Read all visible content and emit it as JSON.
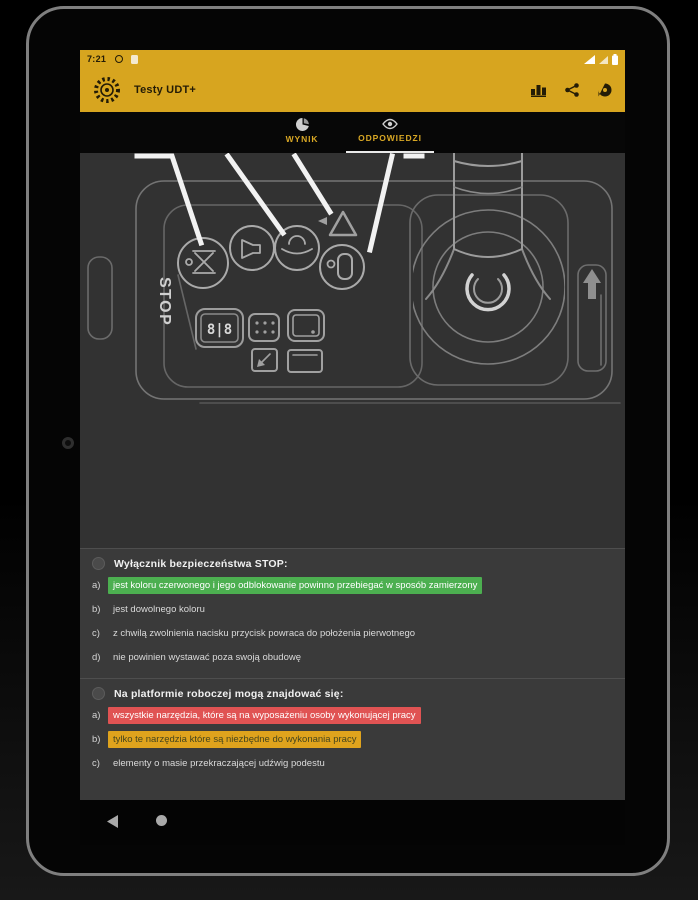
{
  "status_bar": {
    "time": "7:21"
  },
  "app_bar": {
    "title": "Testy UDT+",
    "actions": [
      "leaderboard",
      "share",
      "comment"
    ]
  },
  "tab_bar": {
    "tabs": [
      {
        "label": "WYNIK"
      },
      {
        "label": "ODPOWIEDZI"
      }
    ],
    "selected": "ODPOWIEDZI"
  },
  "diagram": {
    "description": "control panel of mobile elevating work platform with joystick",
    "stop_label": "STOP",
    "hour_meter": "8|8"
  },
  "questions": [
    {
      "text": "Wyłącznik bezpieczeństwa STOP:",
      "answers": [
        {
          "letter": "a)",
          "text": "jest koloru czerwonego i jego odblokowanie powinno przebiegać w sposób zamierzony",
          "highlight": "green"
        },
        {
          "letter": "b)",
          "text": "jest dowolnego koloru",
          "highlight": "none"
        },
        {
          "letter": "c)",
          "text": "z chwilą zwolnienia nacisku przycisk powraca do położenia pierwotnego",
          "highlight": "none"
        },
        {
          "letter": "d)",
          "text": "nie powinien wystawać poza swoją obudowę",
          "highlight": "none"
        }
      ]
    },
    {
      "text": "Na platformie roboczej mogą znajdować się:",
      "answers": [
        {
          "letter": "a)",
          "text": "wszystkie narzędzia, które są na wyposażeniu osoby wykonującej pracy",
          "highlight": "red"
        },
        {
          "letter": "b)",
          "text": "tylko te narzędzia które są niezbędne do wykonania pracy",
          "highlight": "yellow"
        },
        {
          "letter": "c)",
          "text": "elementy o masie przekraczającej udźwig podestu",
          "highlight": "none"
        }
      ]
    }
  ],
  "colors": {
    "app_bar": "#d7a51f",
    "tab_label": "#d9a825",
    "correct_green": "#4caf50",
    "wrong_red": "#e05353",
    "partial_yellow": "#dfa31d"
  }
}
